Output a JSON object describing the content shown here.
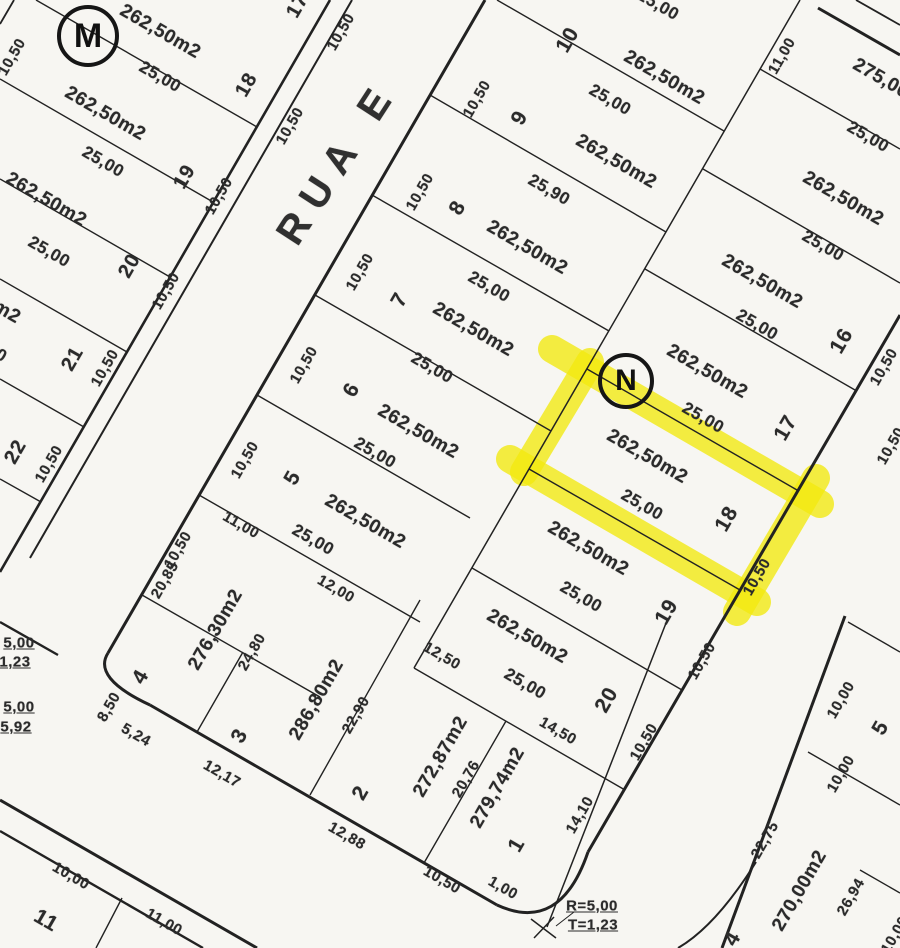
{
  "meta": {
    "paper_color": "#f7f6f2",
    "ink_color": "#222222",
    "highlight_color": "#f2e90e",
    "highlighted_lot": {
      "number": "18",
      "area": "262,50m2",
      "block": "N"
    }
  },
  "street": {
    "name": "RUA E"
  },
  "markers": [
    {
      "label": "M",
      "x": 88,
      "y": 36,
      "d": 54,
      "fs": 34
    },
    {
      "label": "N",
      "x": 626,
      "y": 381,
      "d": 48,
      "fs": 30
    }
  ],
  "labels": [
    {
      "t": "17",
      "x": 298,
      "y": 6,
      "r": -60,
      "s": 20,
      "n": "lot-number"
    },
    {
      "t": "10,50",
      "x": 341,
      "y": 32,
      "r": -60,
      "s": 15,
      "n": "dim-label"
    },
    {
      "t": "262,50m2",
      "x": 160,
      "y": 32,
      "r": 30,
      "s": 19,
      "n": "area-label"
    },
    {
      "t": "25,00",
      "x": 160,
      "y": 77,
      "r": 30,
      "s": 17,
      "n": "dim-label"
    },
    {
      "t": "18",
      "x": 247,
      "y": 85,
      "r": -60,
      "s": 20,
      "n": "lot-number"
    },
    {
      "t": "10,50",
      "x": 290,
      "y": 126,
      "r": -60,
      "s": 15,
      "n": "dim-label"
    },
    {
      "t": "10,50",
      "x": 12,
      "y": 57,
      "r": -60,
      "s": 15,
      "n": "dim-label"
    },
    {
      "t": "262,50m2",
      "x": 105,
      "y": 114,
      "r": 30,
      "s": 19,
      "n": "area-label"
    },
    {
      "t": "25,00",
      "x": 103,
      "y": 162,
      "r": 30,
      "s": 17,
      "n": "dim-label"
    },
    {
      "t": "19",
      "x": 185,
      "y": 177,
      "r": -60,
      "s": 20,
      "n": "lot-number"
    },
    {
      "t": "10,50",
      "x": 219,
      "y": 196,
      "r": -60,
      "s": 15,
      "n": "dim-label"
    },
    {
      "t": "262,50m2",
      "x": 46,
      "y": 200,
      "r": 30,
      "s": 19,
      "n": "area-label"
    },
    {
      "t": "25,00",
      "x": 49,
      "y": 252,
      "r": 30,
      "s": 17,
      "n": "dim-label"
    },
    {
      "t": "20",
      "x": 130,
      "y": 266,
      "r": -60,
      "s": 20,
      "n": "lot-number"
    },
    {
      "t": "10,50",
      "x": 166,
      "y": 291,
      "r": -60,
      "s": 15,
      "n": "dim-label"
    },
    {
      "t": "262,50m2",
      "x": -20,
      "y": 297,
      "r": 30,
      "s": 19,
      "n": "area-label"
    },
    {
      "t": "25,00",
      "x": -14,
      "y": 347,
      "r": 30,
      "s": 17,
      "n": "dim-label"
    },
    {
      "t": "21",
      "x": 73,
      "y": 359,
      "r": -60,
      "s": 20,
      "n": "lot-number"
    },
    {
      "t": "10,50",
      "x": 105,
      "y": 368,
      "r": -60,
      "s": 15,
      "n": "dim-label"
    },
    {
      "t": "22",
      "x": 16,
      "y": 452,
      "r": -60,
      "s": 20,
      "n": "lot-number"
    },
    {
      "t": "10,50",
      "x": 49,
      "y": 464,
      "r": -60,
      "s": 15,
      "n": "dim-label"
    },
    {
      "t": "25,00",
      "x": 658,
      "y": 5,
      "r": 30,
      "s": 17,
      "n": "dim-label"
    },
    {
      "t": "10",
      "x": 568,
      "y": 40,
      "r": -60,
      "s": 21,
      "n": "lot-number"
    },
    {
      "t": "262,50m2",
      "x": 664,
      "y": 78,
      "r": 30,
      "s": 19,
      "n": "area-label"
    },
    {
      "t": "25,00",
      "x": 610,
      "y": 100,
      "r": 30,
      "s": 17,
      "n": "dim-label"
    },
    {
      "t": "10,50",
      "x": 477,
      "y": 99,
      "r": -60,
      "s": 15,
      "n": "dim-label"
    },
    {
      "t": "9",
      "x": 520,
      "y": 118,
      "r": -60,
      "s": 21,
      "n": "lot-number"
    },
    {
      "t": "262,50m2",
      "x": 616,
      "y": 162,
      "r": 30,
      "s": 19,
      "n": "area-label"
    },
    {
      "t": "25,90",
      "x": 549,
      "y": 190,
      "r": 30,
      "s": 17,
      "n": "dim-label"
    },
    {
      "t": "10,50",
      "x": 420,
      "y": 192,
      "r": -60,
      "s": 15,
      "n": "dim-label"
    },
    {
      "t": "8",
      "x": 458,
      "y": 208,
      "r": -60,
      "s": 21,
      "n": "lot-number"
    },
    {
      "t": "262,50m2",
      "x": 527,
      "y": 248,
      "r": 30,
      "s": 19,
      "n": "area-label"
    },
    {
      "t": "25,00",
      "x": 489,
      "y": 287,
      "r": 30,
      "s": 17,
      "n": "dim-label"
    },
    {
      "t": "10,50",
      "x": 360,
      "y": 272,
      "r": -60,
      "s": 15,
      "n": "dim-label"
    },
    {
      "t": "7",
      "x": 400,
      "y": 300,
      "r": -60,
      "s": 21,
      "n": "lot-number"
    },
    {
      "t": "262,50m2",
      "x": 473,
      "y": 330,
      "r": 30,
      "s": 19,
      "n": "area-label"
    },
    {
      "t": "25,00",
      "x": 432,
      "y": 368,
      "r": 30,
      "s": 17,
      "n": "dim-label"
    },
    {
      "t": "10,50",
      "x": 304,
      "y": 365,
      "r": -60,
      "s": 15,
      "n": "dim-label"
    },
    {
      "t": "6",
      "x": 352,
      "y": 390,
      "r": -60,
      "s": 21,
      "n": "lot-number"
    },
    {
      "t": "262,50m2",
      "x": 418,
      "y": 432,
      "r": 30,
      "s": 19,
      "n": "area-label"
    },
    {
      "t": "25,00",
      "x": 375,
      "y": 453,
      "r": 30,
      "s": 17,
      "n": "dim-label"
    },
    {
      "t": "10,50",
      "x": 245,
      "y": 460,
      "r": -60,
      "s": 15,
      "n": "dim-label"
    },
    {
      "t": "5",
      "x": 293,
      "y": 478,
      "r": -60,
      "s": 21,
      "n": "lot-number"
    },
    {
      "t": "262,50m2",
      "x": 365,
      "y": 522,
      "r": 30,
      "s": 19,
      "n": "area-label"
    },
    {
      "t": "25,00",
      "x": 313,
      "y": 540,
      "r": 30,
      "s": 17,
      "n": "dim-label"
    },
    {
      "t": "10,50",
      "x": 178,
      "y": 550,
      "r": -60,
      "s": 15,
      "n": "dim-label"
    },
    {
      "t": "11,00",
      "x": 241,
      "y": 525,
      "r": 30,
      "s": 15,
      "n": "dim-label"
    },
    {
      "t": "275,00m2",
      "x": 893,
      "y": 86,
      "r": 30,
      "s": 19,
      "n": "area-label"
    },
    {
      "t": "11,00",
      "x": 782,
      "y": 56,
      "r": -60,
      "s": 15,
      "n": "dim-label"
    },
    {
      "t": "25,00",
      "x": 868,
      "y": 137,
      "r": 30,
      "s": 17,
      "n": "dim-label"
    },
    {
      "t": "262,50m2",
      "x": 843,
      "y": 199,
      "r": 30,
      "s": 19,
      "n": "area-label"
    },
    {
      "t": "25,00",
      "x": 823,
      "y": 246,
      "r": 30,
      "s": 17,
      "n": "dim-label"
    },
    {
      "t": "262,50m2",
      "x": 762,
      "y": 282,
      "r": 30,
      "s": 19,
      "n": "area-label"
    },
    {
      "t": "25,00",
      "x": 757,
      "y": 325,
      "r": 30,
      "s": 17,
      "n": "dim-label"
    },
    {
      "t": "16",
      "x": 842,
      "y": 341,
      "r": -60,
      "s": 21,
      "n": "lot-number"
    },
    {
      "t": "10,50",
      "x": 884,
      "y": 367,
      "r": -60,
      "s": 15,
      "n": "dim-label"
    },
    {
      "t": "262,50m2",
      "x": 707,
      "y": 372,
      "r": 30,
      "s": 19,
      "n": "area-label"
    },
    {
      "t": "25,00",
      "x": 703,
      "y": 418,
      "r": 30,
      "s": 17,
      "n": "dim-label"
    },
    {
      "t": "17",
      "x": 786,
      "y": 428,
      "r": -60,
      "s": 21,
      "n": "lot-number"
    },
    {
      "t": "10,50",
      "x": 891,
      "y": 446,
      "r": -60,
      "s": 15,
      "n": "dim-label"
    },
    {
      "t": "262,50m2",
      "x": 647,
      "y": 457,
      "r": 30,
      "s": 19,
      "n": "area-label"
    },
    {
      "t": "25,00",
      "x": 642,
      "y": 505,
      "r": 30,
      "s": 17,
      "n": "dim-label"
    },
    {
      "t": "18",
      "x": 727,
      "y": 519,
      "r": -60,
      "s": 21,
      "n": "lot-number"
    },
    {
      "t": "10,50",
      "x": 757,
      "y": 577,
      "r": -60,
      "s": 15,
      "n": "dim-label"
    },
    {
      "t": "262,50m2",
      "x": 588,
      "y": 549,
      "r": 30,
      "s": 19,
      "n": "area-label"
    },
    {
      "t": "25,00",
      "x": 581,
      "y": 597,
      "r": 30,
      "s": 17,
      "n": "dim-label"
    },
    {
      "t": "19",
      "x": 667,
      "y": 612,
      "r": -60,
      "s": 21,
      "n": "lot-number"
    },
    {
      "t": "10,50",
      "x": 702,
      "y": 661,
      "r": -60,
      "s": 15,
      "n": "dim-label"
    },
    {
      "t": "262,50m2",
      "x": 527,
      "y": 637,
      "r": 30,
      "s": 19,
      "n": "area-label"
    },
    {
      "t": "25,00",
      "x": 525,
      "y": 684,
      "r": 30,
      "s": 17,
      "n": "dim-label"
    },
    {
      "t": "20",
      "x": 607,
      "y": 700,
      "r": -60,
      "s": 21,
      "n": "lot-number"
    },
    {
      "t": "10,50",
      "x": 644,
      "y": 742,
      "r": -60,
      "s": 15,
      "n": "dim-label"
    },
    {
      "t": "14,50",
      "x": 558,
      "y": 731,
      "r": 30,
      "s": 15,
      "n": "dim-label"
    },
    {
      "t": "12,50",
      "x": 442,
      "y": 656,
      "r": 30,
      "s": 15,
      "n": "dim-label"
    },
    {
      "t": "279,74m2",
      "x": 498,
      "y": 788,
      "r": -60,
      "s": 19,
      "n": "area-label"
    },
    {
      "t": "20,76",
      "x": 466,
      "y": 779,
      "r": -60,
      "s": 15,
      "n": "dim-label"
    },
    {
      "t": "272,87m2",
      "x": 441,
      "y": 757,
      "r": -60,
      "s": 19,
      "n": "area-label"
    },
    {
      "t": "1",
      "x": 517,
      "y": 845,
      "r": -60,
      "s": 21,
      "n": "lot-number"
    },
    {
      "t": "14,10",
      "x": 580,
      "y": 815,
      "r": -60,
      "s": 15,
      "n": "dim-label"
    },
    {
      "t": "1,00",
      "x": 503,
      "y": 888,
      "r": 30,
      "s": 15,
      "n": "dim-label"
    },
    {
      "t": "10,50",
      "x": 442,
      "y": 880,
      "r": 30,
      "s": 15,
      "n": "dim-label"
    },
    {
      "t": "12,88",
      "x": 347,
      "y": 836,
      "r": 30,
      "s": 15,
      "n": "dim-label"
    },
    {
      "t": "2",
      "x": 361,
      "y": 793,
      "r": -60,
      "s": 21,
      "n": "lot-number"
    },
    {
      "t": "22,90",
      "x": 356,
      "y": 715,
      "r": -60,
      "s": 15,
      "n": "dim-label"
    },
    {
      "t": "286,80m2",
      "x": 317,
      "y": 700,
      "r": -60,
      "s": 19,
      "n": "area-label"
    },
    {
      "t": "3",
      "x": 240,
      "y": 736,
      "r": -60,
      "s": 21,
      "n": "lot-number"
    },
    {
      "t": "24,80",
      "x": 252,
      "y": 652,
      "r": -60,
      "s": 15,
      "n": "dim-label"
    },
    {
      "t": "12,00",
      "x": 336,
      "y": 589,
      "r": 30,
      "s": 15,
      "n": "dim-label"
    },
    {
      "t": "12,17",
      "x": 222,
      "y": 774,
      "r": 30,
      "s": 15,
      "n": "dim-label"
    },
    {
      "t": "276,30m2",
      "x": 216,
      "y": 630,
      "r": -60,
      "s": 19,
      "n": "area-label"
    },
    {
      "t": "4",
      "x": 141,
      "y": 677,
      "r": -60,
      "s": 21,
      "n": "lot-number"
    },
    {
      "t": "20,85",
      "x": 165,
      "y": 580,
      "r": -60,
      "s": 15,
      "n": "dim-label"
    },
    {
      "t": "5,24",
      "x": 136,
      "y": 735,
      "r": 30,
      "s": 15,
      "n": "dim-label"
    },
    {
      "t": "8,50",
      "x": 109,
      "y": 707,
      "r": -60,
      "s": 15,
      "n": "dim-label"
    },
    {
      "t": "R=5,00",
      "x": 592,
      "y": 906,
      "r": 0,
      "s": 15,
      "u": 1,
      "n": "radius-note"
    },
    {
      "t": "T=1,23",
      "x": 593,
      "y": 925,
      "r": 0,
      "s": 15,
      "u": 1,
      "n": "radius-note"
    },
    {
      "t": "5,00",
      "x": 19,
      "y": 643,
      "r": 0,
      "s": 15,
      "u": 1,
      "n": "radius-note"
    },
    {
      "t": "1,23",
      "x": 15,
      "y": 662,
      "r": 0,
      "s": 15,
      "u": 1,
      "n": "radius-note"
    },
    {
      "t": "5,00",
      "x": 19,
      "y": 707,
      "r": 0,
      "s": 15,
      "u": 1,
      "n": "radius-note"
    },
    {
      "t": "5,92",
      "x": 16,
      "y": 727,
      "r": 0,
      "s": 15,
      "u": 1,
      "n": "radius-note"
    },
    {
      "t": "10,00",
      "x": 71,
      "y": 876,
      "r": 30,
      "s": 15,
      "n": "dim-label"
    },
    {
      "t": "11",
      "x": 46,
      "y": 921,
      "r": 30,
      "s": 21,
      "n": "lot-number"
    },
    {
      "t": "11,00",
      "x": 164,
      "y": 922,
      "r": 30,
      "s": 15,
      "n": "dim-label"
    },
    {
      "t": "10,00",
      "x": 841,
      "y": 700,
      "r": -60,
      "s": 15,
      "n": "dim-label"
    },
    {
      "t": "5",
      "x": 881,
      "y": 728,
      "r": -60,
      "s": 21,
      "n": "lot-number"
    },
    {
      "t": "10,00",
      "x": 841,
      "y": 774,
      "r": -60,
      "s": 15,
      "n": "dim-label"
    },
    {
      "t": "22,75",
      "x": 765,
      "y": 840,
      "r": -60,
      "s": 15,
      "n": "dim-label"
    },
    {
      "t": "270,00m2",
      "x": 800,
      "y": 891,
      "r": -60,
      "s": 19,
      "n": "area-label"
    },
    {
      "t": "26,94",
      "x": 851,
      "y": 897,
      "r": -60,
      "s": 15,
      "n": "dim-label"
    },
    {
      "t": "4",
      "x": 733,
      "y": 939,
      "r": -60,
      "s": 21,
      "n": "lot-number"
    },
    {
      "t": "10,00",
      "x": 895,
      "y": 935,
      "r": -60,
      "s": 15,
      "n": "dim-label"
    }
  ],
  "street_label": {
    "t": "RUA E",
    "x": 338,
    "y": 162,
    "r": -57,
    "s": 40
  },
  "highlight": {
    "color": "#f2e90e",
    "opacity": 0.78,
    "width": 28,
    "strokes": [
      [
        552,
        349,
        820,
        504
      ],
      [
        816,
        478,
        737,
        612
      ],
      [
        510,
        459,
        757,
        602
      ],
      [
        590,
        362,
        524,
        472
      ]
    ]
  },
  "lines": [
    [
      330,
      0,
      0,
      572,
      2.6
    ],
    [
      352,
      0,
      30,
      558,
      2.0
    ],
    [
      485,
      0,
      108,
      653,
      3.0
    ],
    [
      150,
      705,
      497,
      905,
      3.0
    ],
    [
      900,
      315,
      588,
      852,
      3.0
    ],
    [
      0,
      800,
      257,
      948,
      3.0
    ],
    [
      0,
      831,
      203,
      948,
      2.4
    ],
    [
      845,
      616,
      722,
      948,
      3.0
    ],
    [
      668,
      618,
      547,
      927,
      1.5
    ],
    [
      818,
      8,
      900,
      55,
      3.0
    ],
    [
      856,
      0,
      900,
      25,
      1.8
    ],
    [
      14,
      0,
      0,
      24,
      1.8
    ],
    [
      0,
      622,
      58,
      655,
      2.4
    ],
    [
      800,
      0,
      414,
      668,
      1.5
    ],
    [
      36,
      0,
      257,
      127,
      1.4
    ],
    [
      0,
      79,
      213,
      202,
      1.4
    ],
    [
      0,
      179,
      170,
      277,
      1.4
    ],
    [
      0,
      279,
      127,
      352,
      1.4
    ],
    [
      0,
      379,
      84,
      427,
      1.4
    ],
    [
      0,
      479,
      41,
      502,
      1.4
    ],
    [
      497,
      0,
      724,
      131,
      1.4
    ],
    [
      430,
      95,
      666,
      232,
      1.4
    ],
    [
      372,
      195,
      609,
      331,
      1.4
    ],
    [
      315,
      295,
      551,
      431,
      1.4
    ],
    [
      257,
      395,
      470,
      518,
      1.4
    ],
    [
      199,
      495,
      420,
      622,
      1.4
    ],
    [
      142,
      595,
      320,
      697,
      1.4
    ],
    [
      760,
      69,
      900,
      149,
      1.4
    ],
    [
      703,
      169,
      900,
      283,
      1.4
    ],
    [
      645,
      269,
      855,
      390,
      1.4
    ],
    [
      587,
      369,
      797,
      490,
      1.4
    ],
    [
      529,
      469,
      740,
      590,
      1.4
    ],
    [
      472,
      568,
      682,
      690,
      1.4
    ],
    [
      414,
      668,
      625,
      790,
      1.4
    ],
    [
      243,
      652,
      197,
      732,
      1.4
    ],
    [
      420,
      600,
      310,
      795,
      1.4
    ],
    [
      506,
      721,
      424,
      863,
      1.4
    ],
    [
      848,
      622,
      900,
      652,
      1.4
    ],
    [
      808,
      752,
      900,
      805,
      1.4
    ],
    [
      860,
      870,
      900,
      893,
      1.4
    ],
    [
      122,
      898,
      96,
      948,
      1.4
    ],
    [
      531,
      919,
      556,
      938,
      1.5
    ],
    [
      534,
      938,
      554,
      917,
      1.5
    ],
    [
      556,
      926,
      574,
      912,
      1.0
    ]
  ],
  "curves": [
    {
      "d": "M108,653 Q92,678 150,705",
      "w": 3.0
    },
    {
      "d": "M497,905 Q560,934 588,852",
      "w": 3.0
    },
    {
      "d": "M756,862 Q716,926 678,948",
      "w": 2.0
    }
  ]
}
